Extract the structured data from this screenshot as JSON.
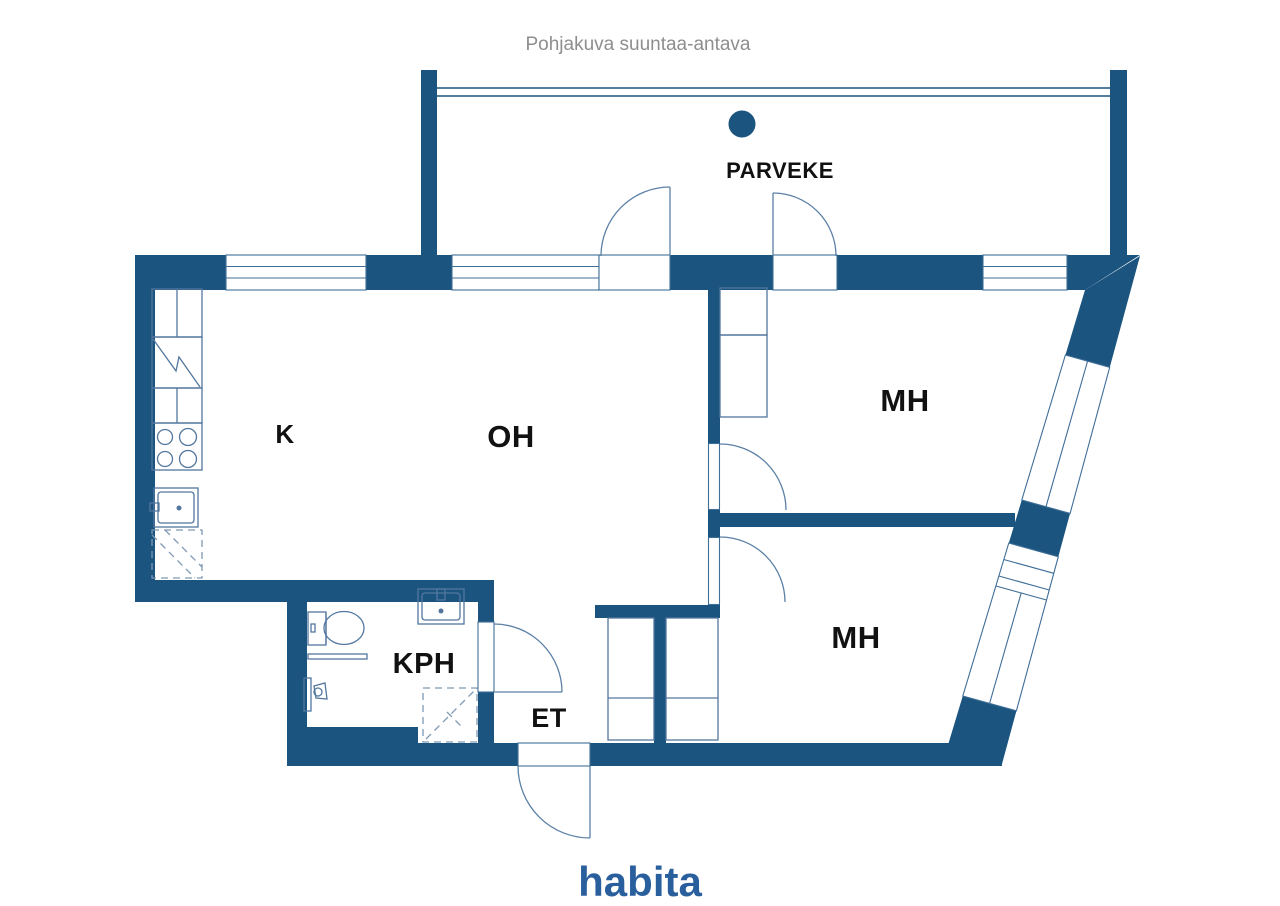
{
  "title": "Pohjakuva suuntaa-antava",
  "logo": "habita",
  "rooms": [
    {
      "id": "parveke",
      "label": "PARVEKE"
    },
    {
      "id": "k",
      "label": "K"
    },
    {
      "id": "oh",
      "label": "OH"
    },
    {
      "id": "mh-top",
      "label": "MH"
    },
    {
      "id": "mh-bottom",
      "label": "MH"
    },
    {
      "id": "kph",
      "label": "KPH"
    },
    {
      "id": "et",
      "label": "ET"
    }
  ],
  "colors": {
    "wall": "#1a547f",
    "fixture_line": "#53779e",
    "label_text": "#111111",
    "title_text": "#8e8e8e",
    "logo_blue": "#2a5f9e",
    "background": "#ffffff"
  }
}
